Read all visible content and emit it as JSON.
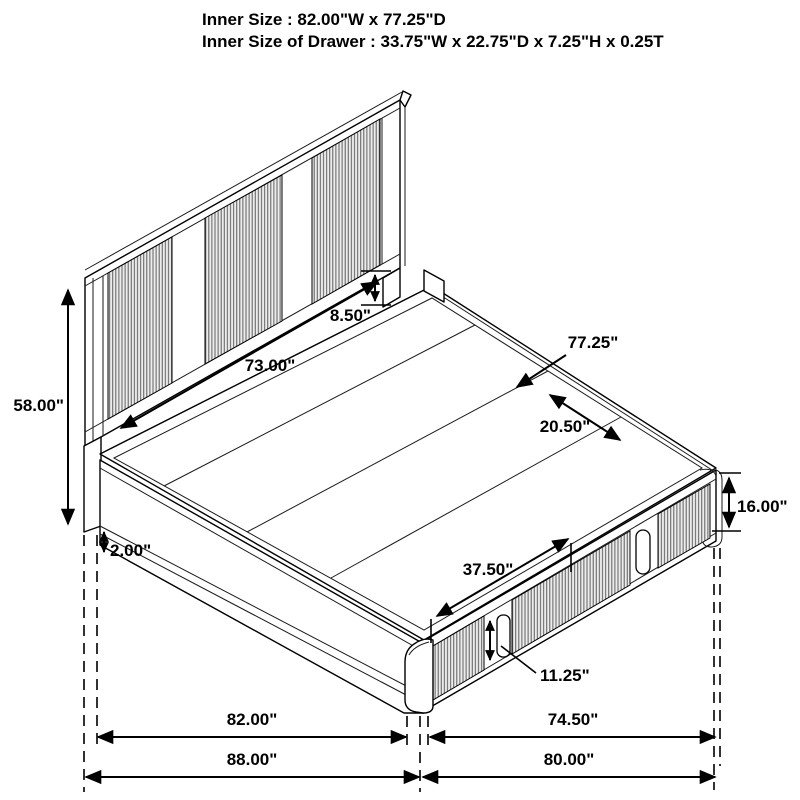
{
  "title": {
    "line1": "Inner Size : 82.00\"W x 77.25\"D",
    "line2": "Inner Size of Drawer : 33.75\"W x 22.75\"D x 7.25\"H x 0.25T"
  },
  "dimensions": {
    "headboard_height": "58.00\"",
    "headboard_panel_width": "73.00\"",
    "headboard_rail_gap": "8.50\"",
    "platform_depth": "77.25\"",
    "slat_width": "20.50\"",
    "leg_clearance": "2.00\"",
    "footboard_height": "16.00\"",
    "drawer_span_width": "37.50\"",
    "drawer_face_height": "11.25\"",
    "inner_width": "82.00\"",
    "footboard_inner_depth": "74.50\"",
    "overall_width": "88.00\"",
    "overall_depth": "80.00\""
  },
  "colors": {
    "line": "#000000",
    "background": "#ffffff",
    "rib_stroke": "#5f5f5f"
  }
}
